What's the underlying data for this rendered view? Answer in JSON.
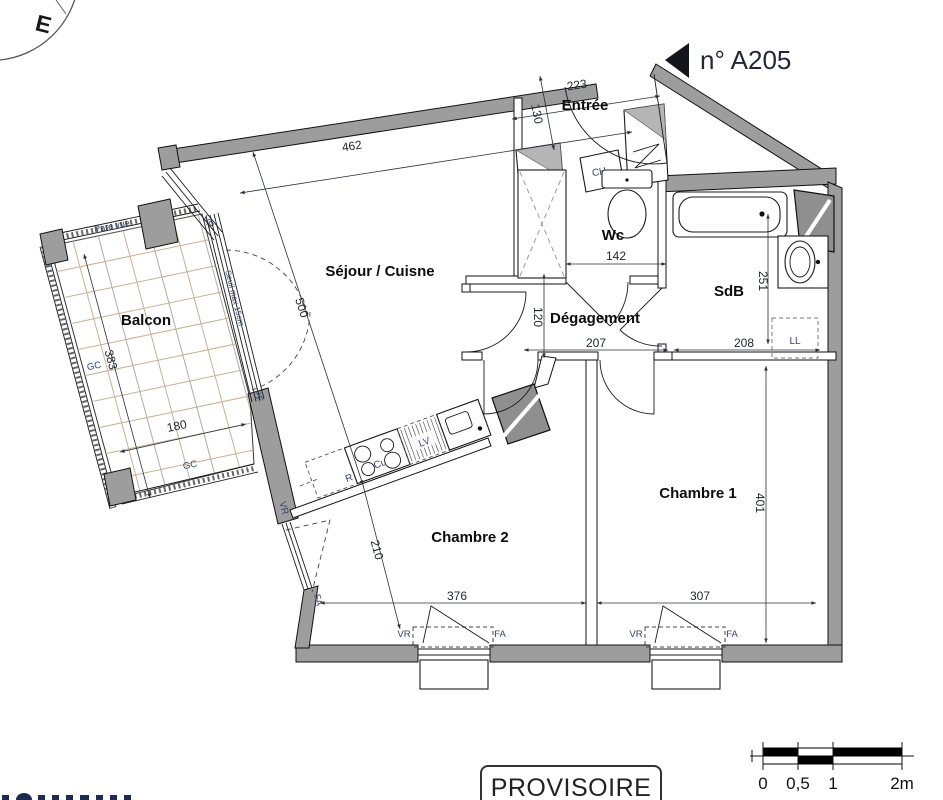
{
  "header": {
    "unit_label": "n° A205",
    "compass_east": "E",
    "stamp": "PROVISOIRE"
  },
  "rooms": {
    "entree": "Entrée",
    "wc": "Wc",
    "sdb": "SdB",
    "degagement": "Dégagement",
    "sejour_cuisine": "Séjour / Cuisne",
    "balcon": "Balcon",
    "chambre1": "Chambre 1",
    "chambre2": "Chambre 2"
  },
  "dimensions_cm": {
    "d223": "223",
    "d130": "130",
    "d462": "462",
    "d500": "500",
    "d142": "142",
    "d251": "251",
    "d120": "120",
    "d207": "207",
    "d208": "208",
    "d401": "401",
    "d210": "210",
    "d376": "376",
    "d307": "307",
    "d383": "383",
    "d180": "180"
  },
  "fixtures": {
    "water_heater": "CH",
    "washer": "LL",
    "fridge": "R",
    "cooktop": "Cu",
    "dishwasher": "LV"
  },
  "openings": {
    "vr": "VR",
    "fa": "FA",
    "pf": "PF",
    "gc": "GC",
    "pare_vue": "Pare vue",
    "seuil_note": "Seuil max 15cm"
  },
  "scale_bar": {
    "t0": "0",
    "t05": "0,5",
    "t1": "1",
    "t2": "2m"
  }
}
